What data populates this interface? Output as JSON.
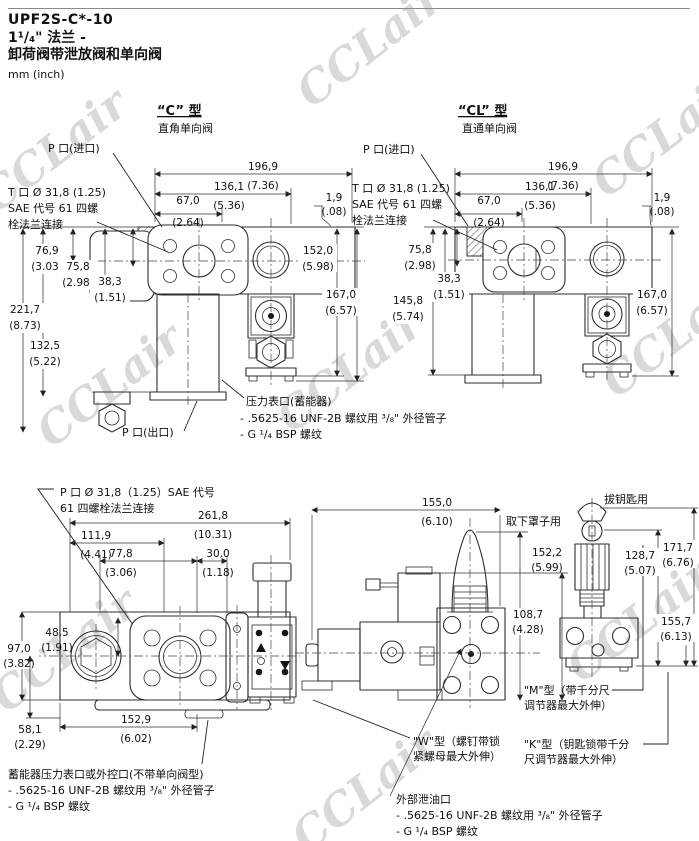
{
  "page": {
    "title_model": "UPF2S-C*-10",
    "title_flange": "1¹/₄\" 法兰 -",
    "title_desc": "卸荷阀带泄放阀和单向阀",
    "units": "mm (inch)",
    "watermark": "CCLair"
  },
  "c": {
    "header": "“C” 型",
    "subtitle": "直角单向阀",
    "labels": {
      "p_in": "P 口(进口)",
      "t1": "T 口 Ø 31,8 (1.25)",
      "t2": "SAE 代号 61 四螺",
      "t3": "栓法兰连接",
      "p_out": "P 口(出口)",
      "g1": "压力表口(蓄能器)",
      "g2": "- .5625-16 UNF-2B 螺纹用 ³/₈\" 外径管子",
      "g3": "- G ¹/₄ BSP 螺纹"
    },
    "dims": {
      "w1_mm": "196,9",
      "w1_in": "(7.36)",
      "w2_mm": "136,1",
      "w2_in": "(5.36)",
      "w3_mm": "67,0",
      "w3_in": "(2.64)",
      "t_mm": "1,9",
      "t_in": "(.08)",
      "h1_mm": "152,0",
      "h1_in": "(5.98)",
      "h2_mm": "167,0",
      "h2_in": "(6.57)",
      "v1_mm": "76,9",
      "v1_in": "(3.03)",
      "v2_mm": "75,8",
      "v2_in": "(2.98)",
      "v3_mm": "38,3",
      "v3_in": "(1.51)",
      "v4_mm": "221,7",
      "v4_in": "(8.73)",
      "v5_mm": "132,5",
      "v5_in": "(5.22)"
    }
  },
  "cl": {
    "header": "“CL” 型",
    "subtitle": "直通单向阀",
    "labels": {
      "p_in": "P 口(进口)",
      "t1": "T 口 Ø 31,8 (1.25)",
      "t2": "SAE 代号 61 四螺",
      "t3": "栓法兰连接"
    },
    "dims": {
      "w1_mm": "196,9",
      "w1_in": "(7.36)",
      "w2_mm": "136,1",
      "w2_in": "(5.36)",
      "w3_mm": "67,0",
      "w3_in": "(2.64)",
      "t_mm": "1,9",
      "t_in": "(.08)",
      "v1_mm": "75,8",
      "v1_in": "(2.98)",
      "v2_mm": "38,3",
      "v2_in": "(1.51)",
      "v3_mm": "145,8",
      "v3_in": "(5.74)",
      "h1_mm": "167,0",
      "h1_in": "(6.57)"
    }
  },
  "bottom": {
    "labels": {
      "p1": "P 口 Ø 31,8（1.25）SAE 代号",
      "p2": "61 四螺栓法兰连接",
      "remove_cover": "取下罩子用",
      "pull_key": "拔钥匙用",
      "acc1": "蓄能器压力表口或外控口(不带单向阀型)",
      "acc2": "- .5625-16 UNF-2B 螺纹用 ³/₈\" 外径管子",
      "acc3": "- G ¹/₄ BSP 螺纹",
      "m1": "\"M\"型（带千分尺",
      "m2": "调节器最大外伸）",
      "w1": "\"W\"型（螺钉带锁",
      "w2": "紧螺母最大外伸）",
      "k1": "\"K\"型（钥匙锁带千分",
      "k2": "尺调节器最大外伸）",
      "drain1": "外部泄油口",
      "drain2": "- .5625-16 UNF-2B 螺纹用 ³/₈\" 外径管子",
      "drain3": "- G ¹/₄ BSP 螺纹"
    },
    "dims": {
      "wt_mm": "261,8",
      "wt_in": "(10.31)",
      "wa_mm": "111,9",
      "wa_in": "(4.41)",
      "wb_mm": "77,8",
      "wb_in": "(3.06)",
      "wc_mm": "30,0",
      "wc_in": "(1.18)",
      "ha_mm": "48,5",
      "ha_in": "(1.91)",
      "hb_mm": "97,0",
      "hb_in": "(3.82)",
      "hc_mm": "58,1",
      "hc_in": "(2.29)",
      "wd_mm": "152,9",
      "wd_in": "(6.02)",
      "we_mm": "155,0",
      "we_in": "(6.10)",
      "hd_mm": "152,2",
      "hd_in": "(5.99)",
      "he_mm": "108,7",
      "he_in": "(4.28)",
      "hk1_mm": "171,7",
      "hk1_in": "(6.76)",
      "hk2_mm": "128,7",
      "hk2_in": "(5.07)",
      "hk3_mm": "155,7",
      "hk3_in": "(6.13)"
    }
  }
}
